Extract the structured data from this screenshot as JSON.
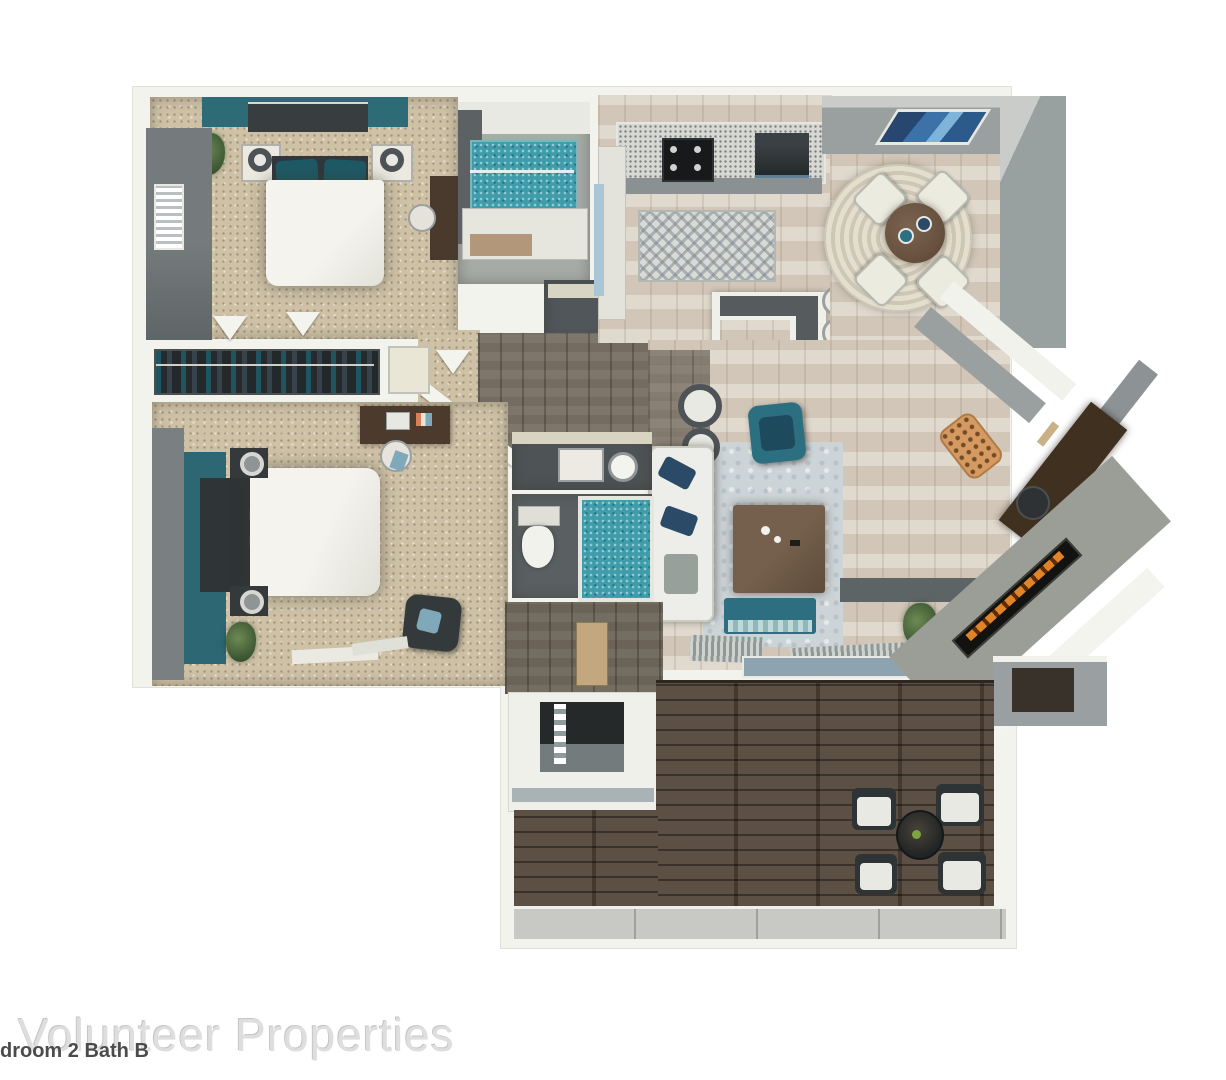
{
  "page": {
    "watermark": "Volunteer Properties",
    "caption": "droom 2 Bath B"
  },
  "areas": [
    {
      "name": "bedroom-1"
    },
    {
      "name": "bathroom-1"
    },
    {
      "name": "laundry-closet"
    },
    {
      "name": "kitchen"
    },
    {
      "name": "dining-area"
    },
    {
      "name": "entry-hall"
    },
    {
      "name": "living-room"
    },
    {
      "name": "desk-nook"
    },
    {
      "name": "bedroom-2"
    },
    {
      "name": "walk-in-closet"
    },
    {
      "name": "bathroom-2"
    },
    {
      "name": "storage-closet"
    },
    {
      "name": "patio-deck"
    }
  ],
  "colors": {
    "accent_teal_wall": "#2d6773",
    "teal_pillow": "#1e5a66",
    "shower_water_teal": "#3f9dab",
    "carpet_beige": "#cec1a6",
    "wood_floor_light": "#d8cec0",
    "hall_wood_dark": "#746c60",
    "deck_wood_brown": "#524437",
    "wall_white": "#f3f3ed",
    "wall_gray": "#9aa0a0",
    "rug_blue_gray": "#cdd4d7",
    "navy_pillow": "#2b4a67",
    "furniture_dark": "#33383a",
    "dining_table_brown": "#69523f",
    "accent_orange_ottoman": "#d59a62",
    "fireplace_flame_orange": "#e08427",
    "art_blue": "#3c72a8",
    "concrete_gray": "#c8c8c4"
  }
}
